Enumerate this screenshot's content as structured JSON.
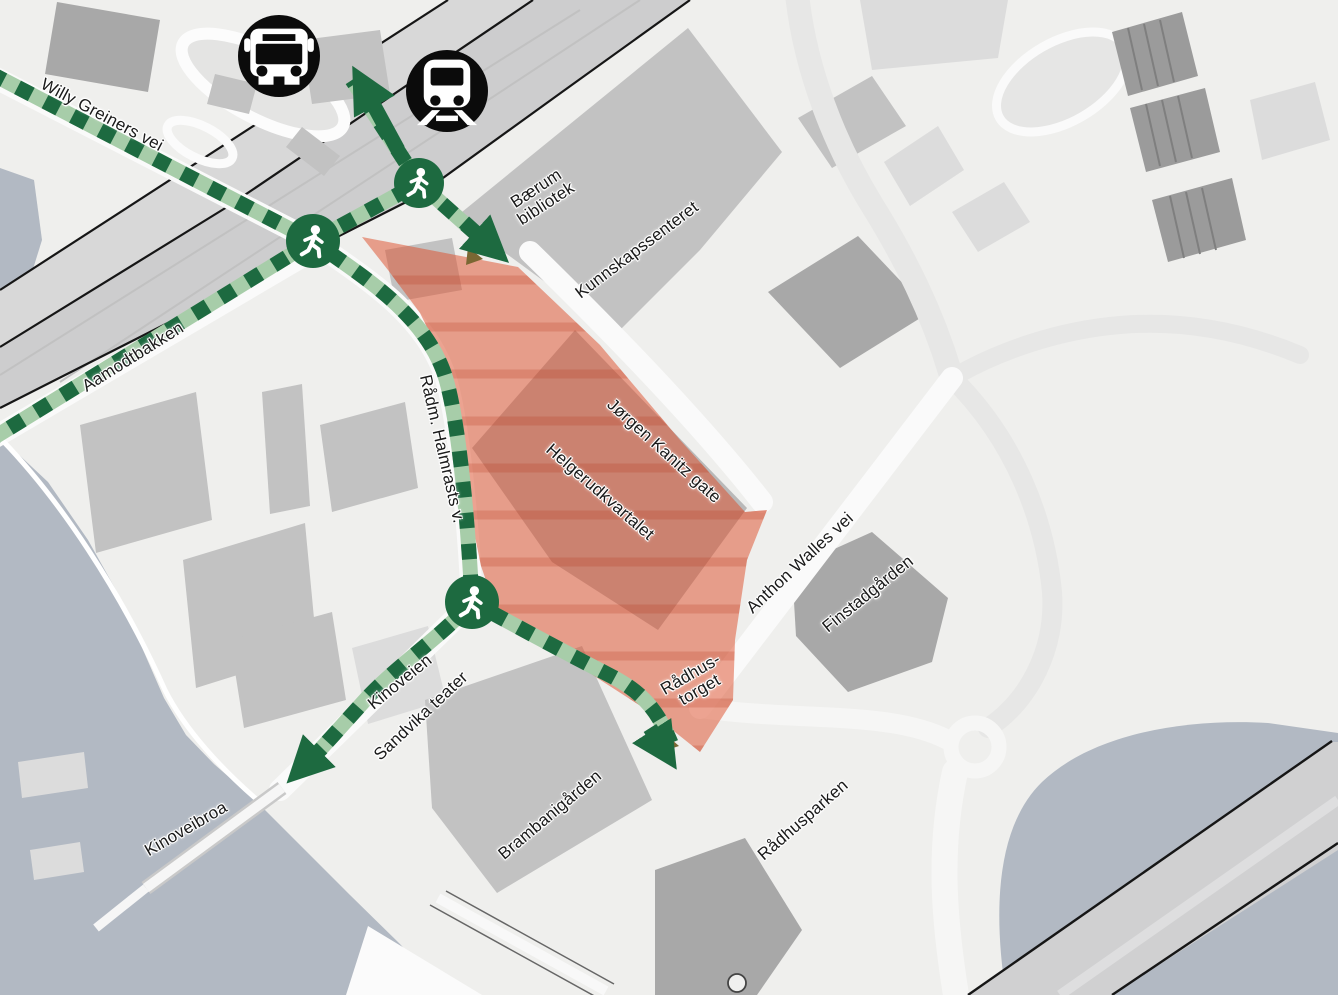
{
  "map": {
    "width": 1338,
    "height": 995,
    "colors": {
      "background": "#efefed",
      "water": "#b2b9c3",
      "railway": "#cdcdce",
      "building_light": "#dcdcdc",
      "building_medium": "#c2c2c2",
      "building_dark": "#a8a8a8",
      "road_white": "#fafafa",
      "line_black": "#161616",
      "route_dark": "#1d6a40",
      "route_light": "#a7cda9",
      "highlight_red": "rgba(221,75,39,0.5)",
      "highlight_stripe": "rgba(180,50,25,0.22)",
      "transit_bg": "#0b0b0b",
      "label_text": "#1a1a1a"
    }
  },
  "labels": [
    {
      "id": "willy-greiners-vei",
      "text": "Willy Greiners vei",
      "lines": [
        "Willy Greiners vei"
      ],
      "x": 102,
      "y": 115,
      "rot": 28
    },
    {
      "id": "aamodtbakken",
      "text": "Aamodtbakken",
      "lines": [
        "Aamodtbakken"
      ],
      "x": 133,
      "y": 357,
      "rot": -32
    },
    {
      "id": "radm-halmrasts-v",
      "text": "Rådm. Halmrasts v.",
      "lines": [
        "Rådm. Halmrasts v."
      ],
      "x": 442,
      "y": 449,
      "rot": 77
    },
    {
      "id": "baerum-bibliotek",
      "text": "Bærum bibliotek",
      "lines": [
        "Bærum",
        "bibliotek"
      ],
      "x": 541,
      "y": 196,
      "rot": -33
    },
    {
      "id": "kunnskapssenteret",
      "text": "Kunnskapssenteret",
      "lines": [
        "Kunnskapssenteret"
      ],
      "x": 637,
      "y": 250,
      "rot": -37
    },
    {
      "id": "jorgen-kanitz-gate",
      "text": "Jørgen Kanitz gate",
      "lines": [
        "Jørgen Kanitz gate"
      ],
      "x": 664,
      "y": 451,
      "rot": 42
    },
    {
      "id": "helgerudkvartalet",
      "text": "Helgerudkvartalet",
      "lines": [
        "Helgerudkvartalet"
      ],
      "x": 600,
      "y": 492,
      "rot": 41
    },
    {
      "id": "anthon-walles-vei",
      "text": "Anthon Walles vei",
      "lines": [
        "Anthon Walles vei"
      ],
      "x": 800,
      "y": 563,
      "rot": -43
    },
    {
      "id": "finstadgarden",
      "text": "Finstadgården",
      "lines": [
        "Finstadgården"
      ],
      "x": 868,
      "y": 594,
      "rot": -39
    },
    {
      "id": "radhustorget",
      "text": "Rådhus-torget",
      "lines": [
        "Rådhus-",
        "torget"
      ],
      "x": 695,
      "y": 682,
      "rot": -30
    },
    {
      "id": "kinoveien",
      "text": "Kinoveien",
      "lines": [
        "Kinoveien"
      ],
      "x": 400,
      "y": 682,
      "rot": -39
    },
    {
      "id": "sandvika-teater",
      "text": "Sandvika teater",
      "lines": [
        "Sandvika teater"
      ],
      "x": 421,
      "y": 716,
      "rot": -43
    },
    {
      "id": "brambanigarden",
      "text": "Brambanigården",
      "lines": [
        "Brambanigården"
      ],
      "x": 550,
      "y": 815,
      "rot": -40
    },
    {
      "id": "radhusparken",
      "text": "Rådhusparken",
      "lines": [
        "Rådhusparken"
      ],
      "x": 803,
      "y": 820,
      "rot": -41
    },
    {
      "id": "kinoveibroa",
      "text": "Kinoveibroa",
      "lines": [
        "Kinoveibroa"
      ],
      "x": 186,
      "y": 829,
      "rot": -30
    }
  ],
  "transit_stops": [
    {
      "id": "bus-stop",
      "x": 279,
      "y": 56,
      "d": 82
    },
    {
      "id": "train-station",
      "x": 447,
      "y": 91,
      "d": 82
    }
  ],
  "route": {
    "nodes": [
      {
        "id": "crossing-north-west",
        "x": 313,
        "y": 241,
        "d": 54
      },
      {
        "id": "crossing-north-east",
        "x": 419,
        "y": 183,
        "d": 50
      },
      {
        "id": "crossing-south",
        "x": 472,
        "y": 602,
        "d": 54
      }
    ]
  }
}
